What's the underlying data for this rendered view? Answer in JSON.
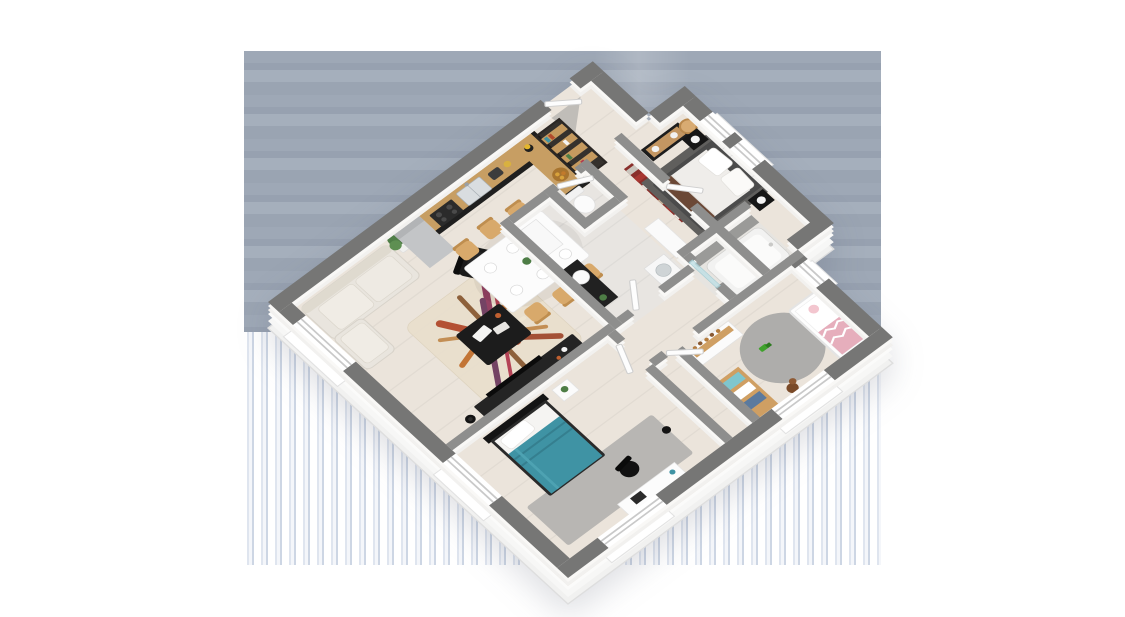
{
  "meta": {
    "title": "3D isometric floor plan of a single-storey house",
    "description": "Axonometric render of a house interior with open living-kitchen-dining area, entrance, WC, bathroom, master bedroom, bathtub room, kids bedroom and second bedroom, on a striped blue-gray render backdrop"
  },
  "palette": {
    "background": "#FFFFFF",
    "backdrop_blue": "#9EA8B6",
    "backdrop_stripe": "#DFE5EF",
    "wall_top_exterior": "#767675",
    "wall_top_interior": "#8E8E8D",
    "wall_face": "#F5F4F2",
    "floor_wood": "#EBE4DB",
    "floor_tile": "#E8E5E1",
    "sofa": "#E9E5DE",
    "rug_cream": "#E9DFCD",
    "rug_red": "#B24A2C",
    "rug_plum": "#8F3A5D",
    "rug_orange": "#C1702E",
    "wood_counter": "#C79E63",
    "black_furniture": "#1E1E1E",
    "teal_bed": "#3F93A4",
    "gray_rug": "#B8B6B3",
    "master_duvet": "#EFEDEA",
    "master_dark_rug": "#605F5D",
    "throw_brown": "#6B4836",
    "crib_pink": "#E6AEBC",
    "kids_round_rug": "#AEADAB",
    "plant_green": "#4E7D46",
    "glass": "#BFE0E6"
  },
  "rooms": [
    {
      "id": "living",
      "label": "living room",
      "furniture": [
        "corner-sofa",
        "colorful-area-rug",
        "coffee-table",
        "black-armchair",
        "tv-sideboard",
        "floor-lamp",
        "potted-plant"
      ]
    },
    {
      "id": "kitchen",
      "label": "open kitchen",
      "furniture": [
        "tall-fridge-cabinet",
        "counter-with-double-sink",
        "cooktop",
        "toaster",
        "bar-counter",
        "fruit-bowl",
        "blender"
      ]
    },
    {
      "id": "dining",
      "label": "dining area",
      "furniture": [
        "white-dining-table",
        "six-wooden-chairs",
        "place-settings",
        "table-plant"
      ]
    },
    {
      "id": "entrance",
      "label": "entrance hall",
      "furniture": [
        "front-door",
        "metal-bookshelf",
        "open-wardrobe-with-clothes",
        "storage-cabinet"
      ]
    },
    {
      "id": "wc",
      "label": "toilet room",
      "furniture": [
        "toilet"
      ]
    },
    {
      "id": "bathroom",
      "label": "bathroom",
      "furniture": [
        "black-vanity-with-round-basin",
        "tall-white-cabinet",
        "washing-machine"
      ]
    },
    {
      "id": "master",
      "label": "master bedroom",
      "furniture": [
        "double-bed-white-duvet",
        "brown-throw",
        "two-black-nightstands",
        "sphere-table-lamps",
        "black-dresser-wood-drawers",
        "wooden-chair",
        "dark-gray-rug"
      ]
    },
    {
      "id": "bathtub-room",
      "label": "bathtub room",
      "furniture": [
        "bathtub",
        "glass-screen",
        "tiled-deck"
      ]
    },
    {
      "id": "kids",
      "label": "kids bedroom",
      "furniture": [
        "white-crib-pink-bedding",
        "changing-dresser-with-toys",
        "toy-shelf-teal-boxes",
        "round-gray-rug",
        "teddy-bear",
        "green-toy"
      ]
    },
    {
      "id": "bedroom2",
      "label": "second bedroom",
      "furniture": [
        "single-bed-teal-duvet",
        "black-headboard",
        "white-nightstand-plant",
        "gray-rug",
        "white-desk",
        "black-desk-chair"
      ]
    },
    {
      "id": "hallway",
      "label": "hallway",
      "furniture": [
        "white-doors"
      ]
    }
  ]
}
